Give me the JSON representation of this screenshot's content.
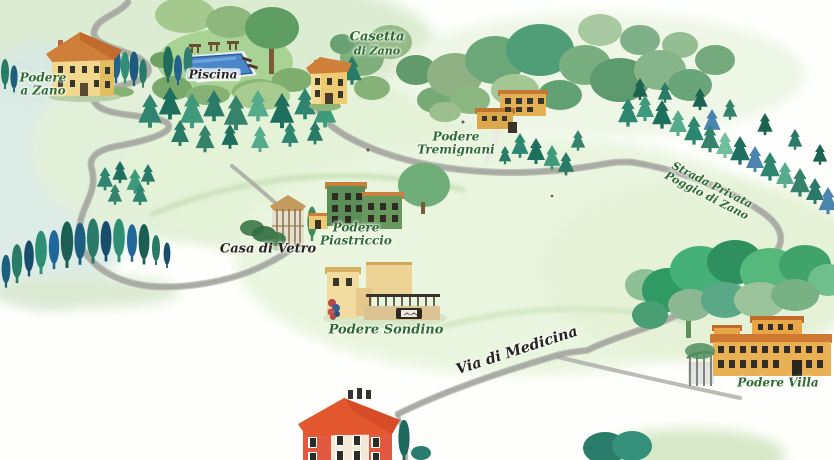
{
  "map": {
    "locations": {
      "podere_a_zano": {
        "line1": "Podere",
        "line2": "a Zano"
      },
      "piscina": {
        "line1": "Piscina"
      },
      "casetta_di_zano": {
        "line1": "Casetta",
        "line2": "di Zano"
      },
      "podere_tremignani": {
        "line1": "Podere",
        "line2": "Tremignani"
      },
      "casa_di_vetro": {
        "line1": "Casa di Vetro"
      },
      "podere_piastriccio": {
        "line1": "Podere",
        "line2": "Piastriccio"
      },
      "podere_sondino": {
        "line1": "Podere Sondino"
      },
      "podere_villa": {
        "line1": "Podere Villa"
      }
    },
    "roads": {
      "strada_privata_poggio_di_zano": {
        "line1": "Strada Privata",
        "line2": "Poggio di Zano"
      },
      "via_di_medicina": {
        "line1": "Via di Medicina"
      }
    },
    "colors": {
      "label_green": "#2d6b31",
      "label_black": "#26241e",
      "road_gray": "#a5a6a0",
      "water_blue": "#4a86c8",
      "roof_orange": "#d07f3a",
      "wall_yellow": "#f2d88f",
      "red_house": "#e2572e",
      "pine_teal": "#2e8570",
      "cypress_blue": "#20689a"
    }
  }
}
